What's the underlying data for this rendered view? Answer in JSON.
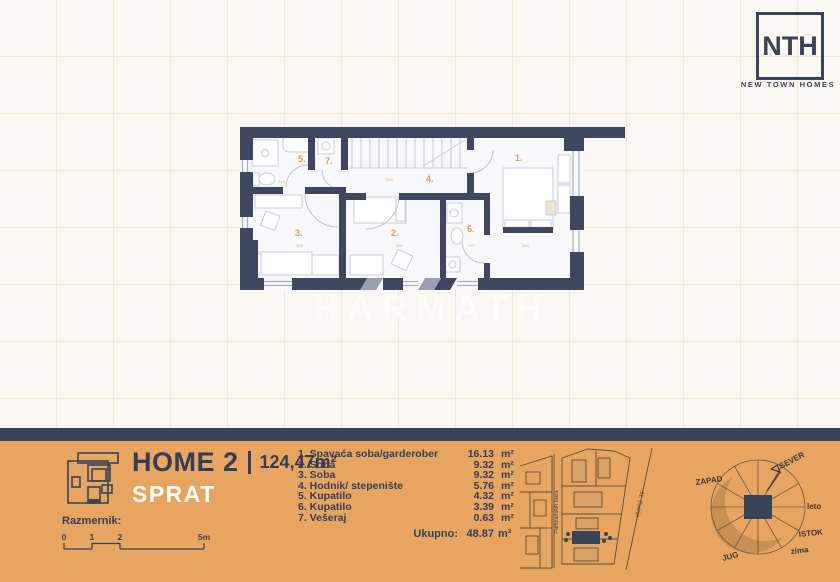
{
  "logo": {
    "monogram": "NTH",
    "brand": "NEW TOWN HOMES"
  },
  "watermark": {
    "title": "HARMATH",
    "subtitle": "NEKRETNINE"
  },
  "plan": {
    "labels": [
      "1.",
      "2.",
      "3.",
      "4.",
      "5.",
      "6.",
      "7."
    ],
    "dims": [
      "210",
      "344",
      "329",
      "330",
      "177",
      "314"
    ]
  },
  "footer": {
    "title": "HOME 2",
    "area": "124,47m²",
    "subtitle": "SPRAT",
    "scale_label": "Razmernik:",
    "scale_ticks": [
      "0",
      "1",
      "2",
      "5m"
    ],
    "rooms": [
      {
        "name": "1. Spavaća soba/garderober",
        "value": "16.13",
        "unit": "m²"
      },
      {
        "name": "2. Soba",
        "value": "9.32",
        "unit": "m²"
      },
      {
        "name": "3. Soba",
        "value": "9.32",
        "unit": "m²"
      },
      {
        "name": "4. Hodnik/ stepenište",
        "value": "5.76",
        "unit": "m²"
      },
      {
        "name": "5. Kupatilo",
        "value": "4.32",
        "unit": "m²"
      },
      {
        "name": "6. Kupatilo",
        "value": "3.39",
        "unit": "m²"
      },
      {
        "name": "7. Vešeraj",
        "value": "0.63",
        "unit": "m²"
      }
    ],
    "total_label": "Ukupno:",
    "total_value": "48.87",
    "total_unit": "m²",
    "sitemap": {
      "street_vertical": "Partizanskih baza",
      "street_diagonal": "51. Divizije"
    },
    "compass": {
      "north": "SEVER",
      "west": "ZAPAD",
      "east": "ISTOK",
      "south": "JUG",
      "summer": "leto",
      "winter": "zima"
    }
  },
  "colors": {
    "navy": "#3A4458",
    "orange": "#E7A561",
    "label_orange": "#E59B51",
    "cream": "#FBF7F1"
  }
}
